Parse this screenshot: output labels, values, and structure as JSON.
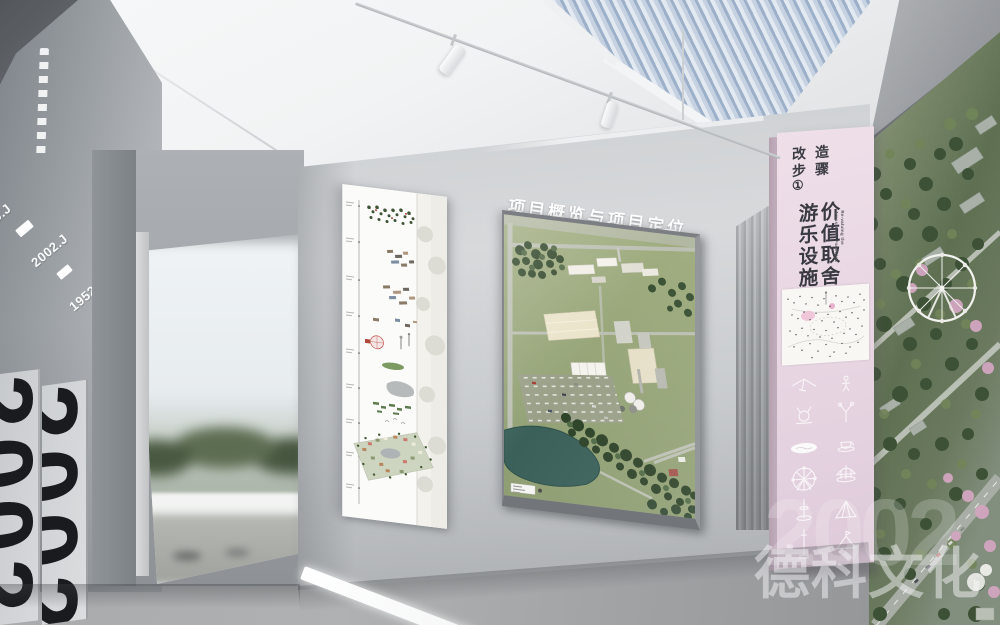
{
  "header": {
    "title_zh": "项目概览与项目定位",
    "title_en": "Project Preview and the Regeneration Strategy Analysis",
    "section_number": "2",
    "number_suffix": ","
  },
  "left_wall": {
    "year_labels": [
      "B.J",
      "2002.J",
      "1952.J"
    ],
    "panel_numbers": [
      "2002",
      "2002"
    ]
  },
  "timeline_panel": {
    "tick_count": 9,
    "content": [
      "tree-scatter",
      "factory-clusters",
      "ferris-wheel-sketch",
      "lake-outline",
      "green-field",
      "axonometric-site-map"
    ]
  },
  "site_board": {
    "content": [
      "aerial-site-model",
      "industrial-buildings",
      "tree-belt",
      "parking-lot",
      "lake",
      "silos",
      "legend-label"
    ]
  },
  "banner": {
    "color": "#e8d6e3",
    "step_lines": [
      "改造",
      "步骤",
      "①"
    ],
    "headline_right": "价值取舍",
    "headline_left": "游乐设施",
    "subtitle_en_lines": [
      "Re-valuing the",
      "Amusement Facilities"
    ],
    "icons": [
      "hang-glider",
      "swing-figure",
      "animal-coaster",
      "slingshot-tower",
      "wave-pool",
      "teacup-ride",
      "ferris-wheel",
      "carousel",
      "drop-spindle",
      "pyramid-slide",
      "drop-tower",
      "canopy-tent"
    ]
  },
  "mural": {
    "subject": "aerial-amusement-park-hillside",
    "features": [
      "ferris-wheel",
      "blossom-trees",
      "winding-road",
      "forest"
    ]
  },
  "watermark": {
    "number": "2002",
    "text": "德科文化"
  },
  "colors": {
    "banner_pink": "#e8d6e3",
    "lake_teal": "#3a6059",
    "grass_green": "#94a374",
    "tree_green": "#33492c",
    "wall_gray": "#9aa0a5",
    "floor_gray": "#a0a2a4"
  }
}
